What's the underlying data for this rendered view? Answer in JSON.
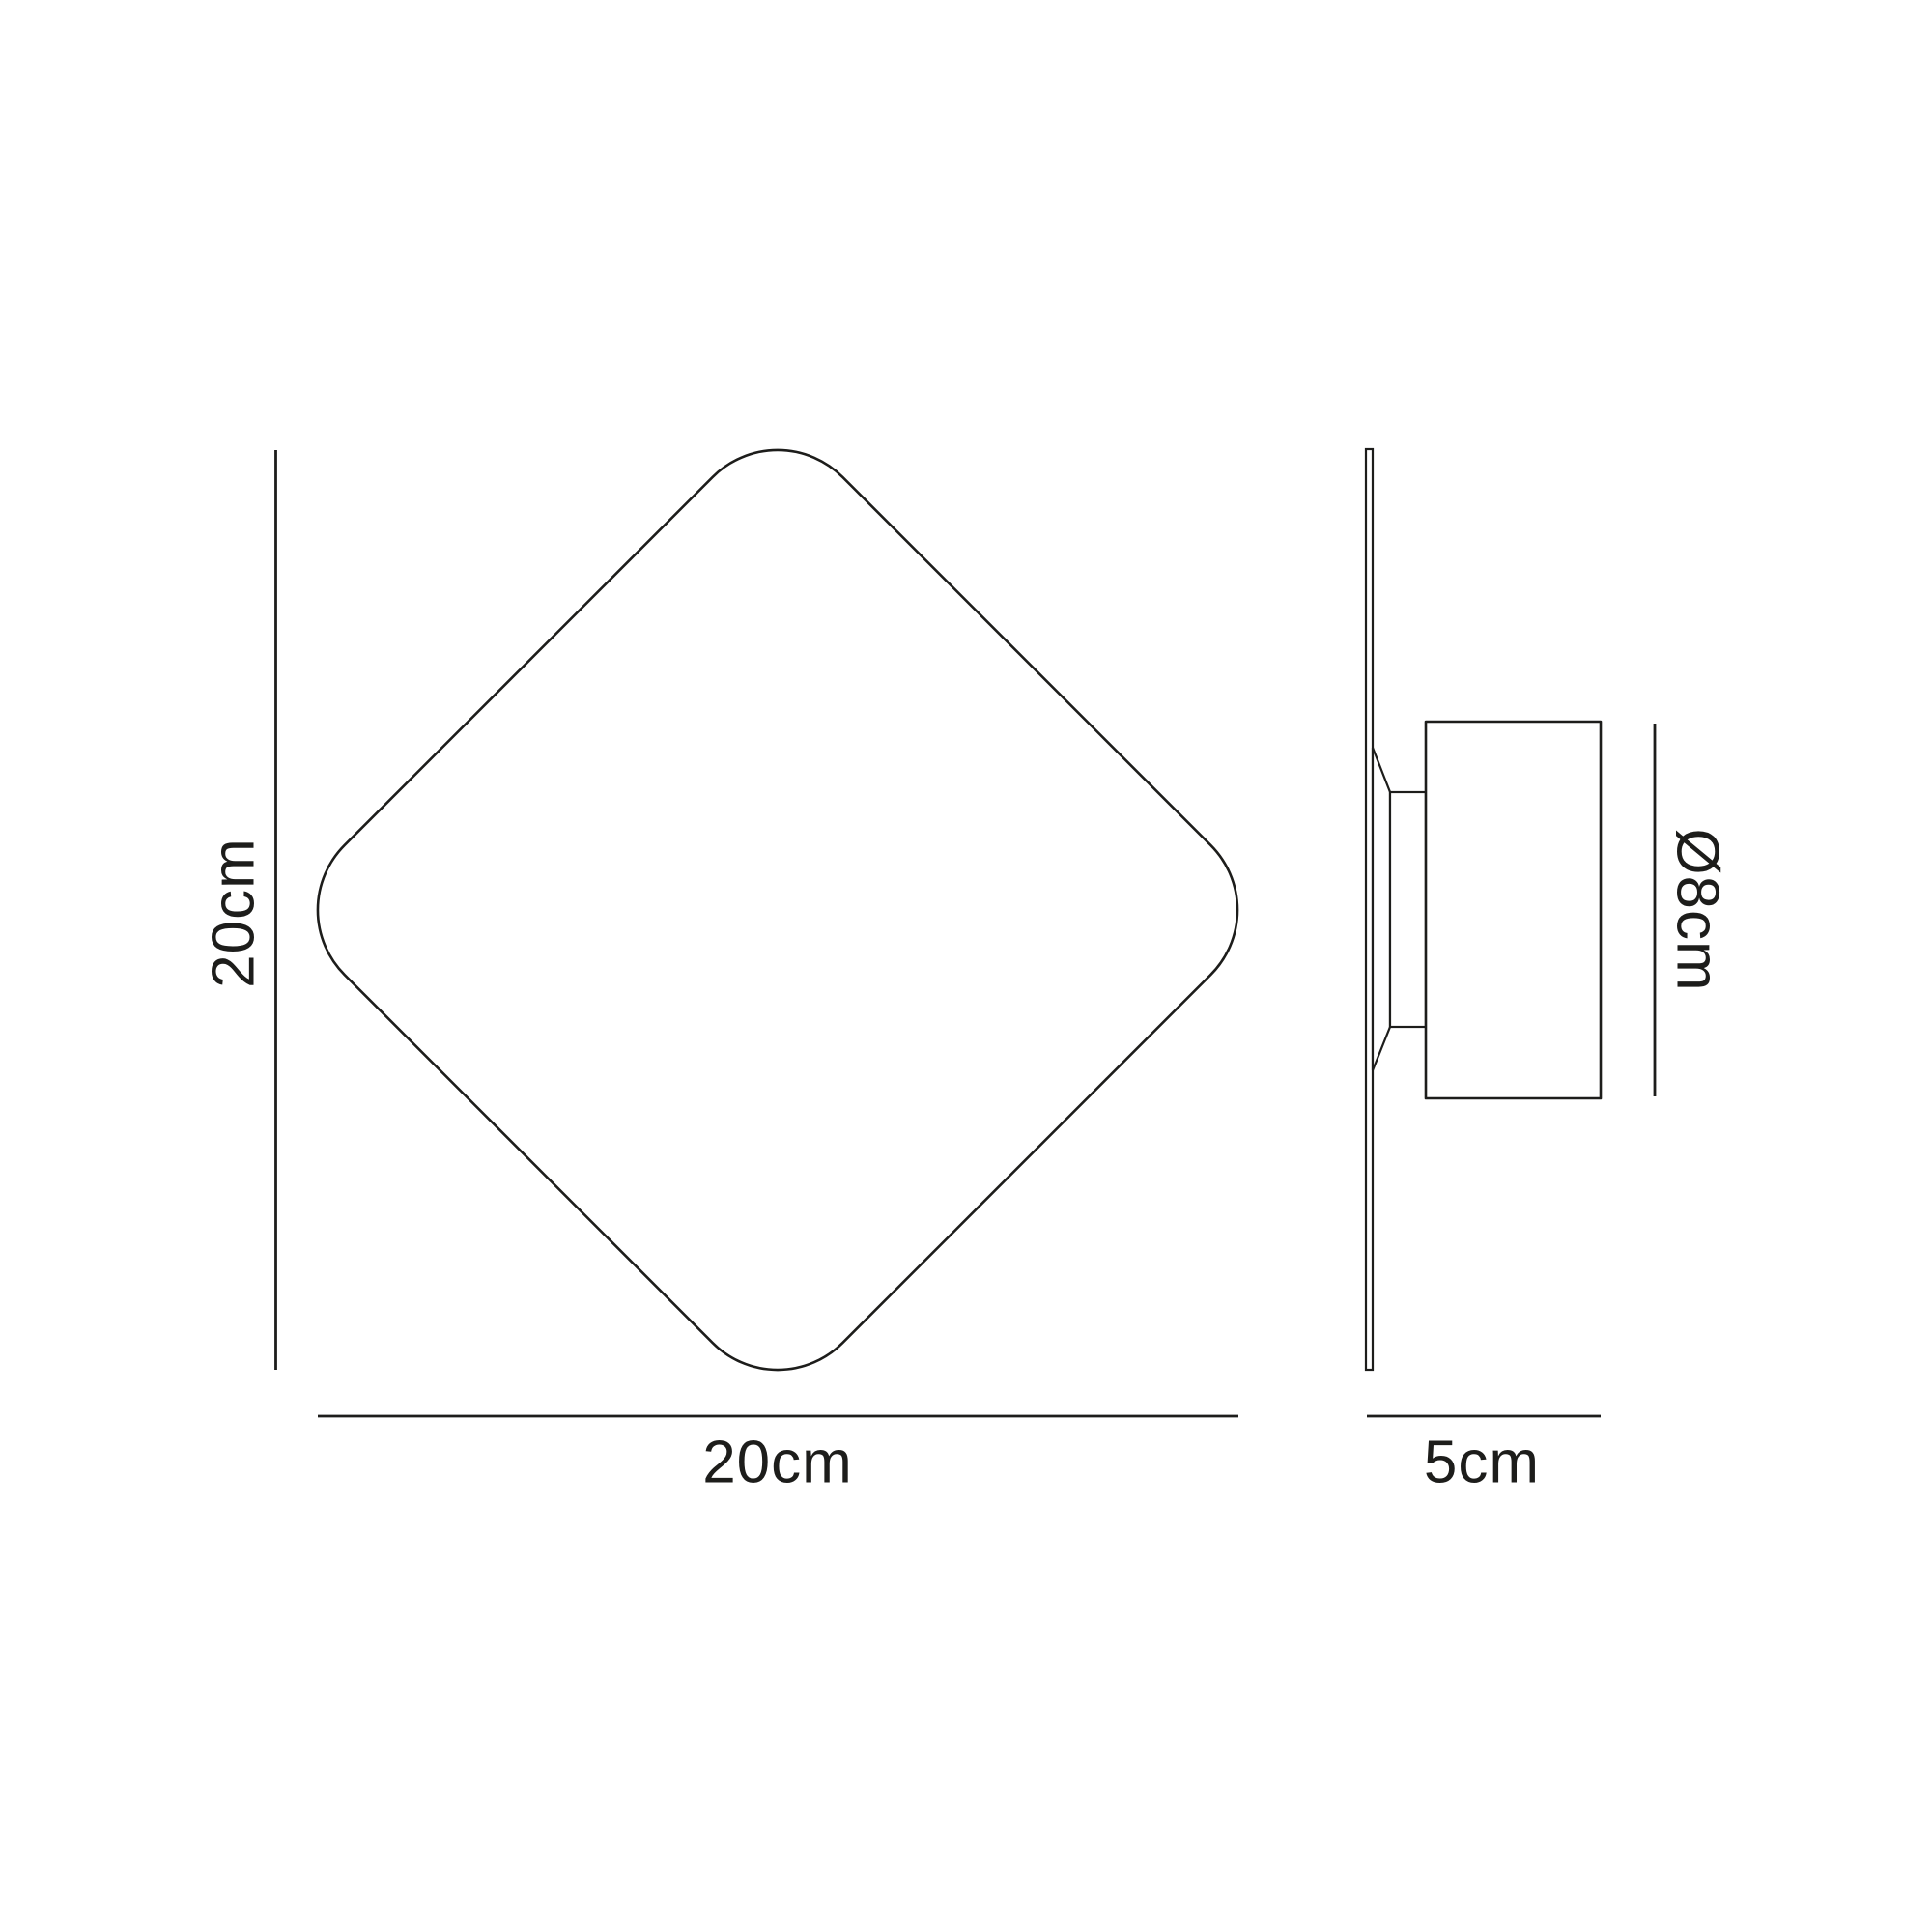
{
  "page": {
    "background": "#ffffff",
    "line_color": "#1d1d1b",
    "description": "Technical dimension drawing of a diamond-shaped wall light, front and side views"
  },
  "front_view": {
    "height_label": "20cm",
    "width_label": "20cm"
  },
  "side_view": {
    "diameter_label": "Ø8cm",
    "depth_label": "5cm"
  }
}
